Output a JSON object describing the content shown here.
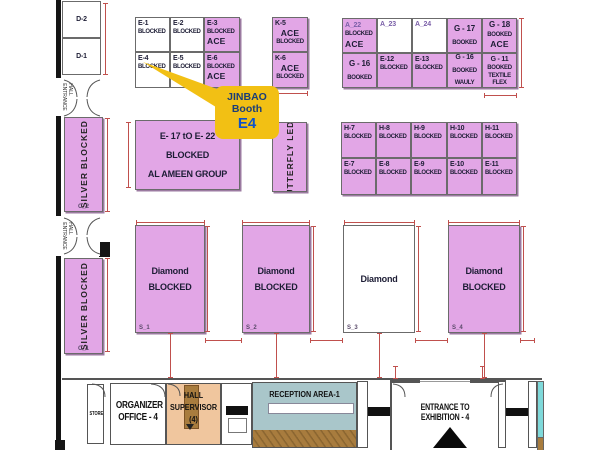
{
  "colors": {
    "pink": "#e2a6e6",
    "yellow": "#f2c014",
    "navy": "#1b3d77",
    "blue": "#0d52c8",
    "red": "#c0504d",
    "orange": "#f0c69e",
    "teal": "#a9c6ca",
    "tealstrip": "#7fd9da",
    "wood": "#a87c3e"
  },
  "callout": {
    "brand": "JINBAO",
    "line2": "Booth",
    "booth_id": "E4"
  },
  "left_wing": {
    "hall_entrance": "HALL ENTRANCE"
  },
  "bottom_band": {
    "store": "STORE",
    "organizer_line1": "ORGANIZER",
    "organizer_line2": "OFFICE - 4",
    "supervisor_lines": [
      "HALL",
      "SUPERVISOR",
      "(4)"
    ],
    "reception": "RECEPTION AREA-1",
    "entrance": "ENTRANCE TO EXHIBITION - 4"
  },
  "booths": [
    {
      "id": "D-2",
      "x": 62,
      "y": 1,
      "w": 39,
      "h": 37,
      "fill": "white",
      "cls": "mid",
      "lines": [
        {
          "t": "D-2",
          "c": "id c"
        }
      ]
    },
    {
      "id": "D-1",
      "x": 62,
      "y": 38,
      "w": 39,
      "h": 37,
      "fill": "white",
      "cls": "mid",
      "lines": [
        {
          "t": "D-1",
          "c": "id c"
        }
      ]
    },
    {
      "id": "C_2",
      "x": 64,
      "y": 117,
      "w": 39,
      "h": 95,
      "fill": "pink",
      "vert": true,
      "tag": "C_2",
      "lines": [
        {
          "t": "SILVER"
        },
        {
          "t": "BLOCKED"
        }
      ]
    },
    {
      "id": "C_1",
      "x": 64,
      "y": 258,
      "w": 39,
      "h": 96,
      "fill": "pink",
      "vert": true,
      "tag": "C_1",
      "lines": [
        {
          "t": "SILVER"
        },
        {
          "t": "BLOCKED"
        }
      ]
    },
    {
      "id": "E-1",
      "x": 135,
      "y": 17,
      "w": 35,
      "h": 35,
      "fill": "white",
      "lines": [
        {
          "t": "E-1",
          "c": "id"
        },
        {
          "t": "BLOCKED",
          "c": "t"
        }
      ]
    },
    {
      "id": "E-2",
      "x": 170,
      "y": 17,
      "w": 34,
      "h": 35,
      "fill": "white",
      "lines": [
        {
          "t": "E-2",
          "c": "id"
        },
        {
          "t": "BLOCKED",
          "c": "t"
        }
      ]
    },
    {
      "id": "E-3",
      "x": 204,
      "y": 17,
      "w": 36,
      "h": 35,
      "fill": "pink",
      "lines": [
        {
          "t": "E-3",
          "c": "id"
        },
        {
          "t": "BLOCKED",
          "c": "t"
        },
        {
          "t": "ACE",
          "c": "a"
        }
      ]
    },
    {
      "id": "E-4",
      "x": 135,
      "y": 52,
      "w": 35,
      "h": 36,
      "fill": "white",
      "lines": [
        {
          "t": "E-4",
          "c": "id"
        },
        {
          "t": "BLOCKED",
          "c": "t"
        }
      ]
    },
    {
      "id": "E-5",
      "x": 170,
      "y": 52,
      "w": 34,
      "h": 36,
      "fill": "white",
      "lines": [
        {
          "t": "E-5",
          "c": "id"
        },
        {
          "t": "BLOCKED",
          "c": "t"
        }
      ]
    },
    {
      "id": "E-6",
      "x": 204,
      "y": 52,
      "w": 36,
      "h": 36,
      "fill": "pink",
      "lines": [
        {
          "t": "E-6",
          "c": "id"
        },
        {
          "t": "BLOCKED",
          "c": "t"
        },
        {
          "t": "ACE",
          "c": "a"
        }
      ]
    },
    {
      "id": "K-5",
      "x": 272,
      "y": 17,
      "w": 36,
      "h": 35,
      "fill": "pink",
      "lines": [
        {
          "t": "K-5",
          "c": "id"
        },
        {
          "t": "ACE",
          "c": "a c"
        },
        {
          "t": "BLOCKED",
          "c": "t c"
        }
      ]
    },
    {
      "id": "K-6",
      "x": 272,
      "y": 52,
      "w": 36,
      "h": 36,
      "fill": "pink",
      "lines": [
        {
          "t": "K-6",
          "c": "id"
        },
        {
          "t": "ACE",
          "c": "a c"
        },
        {
          "t": "BLOCKED",
          "c": "t c"
        }
      ]
    },
    {
      "id": "A_22",
      "x": 342,
      "y": 18,
      "w": 35,
      "h": 35,
      "fill": "pink",
      "cls": "sp",
      "lines": [
        {
          "t": "A_22",
          "c": "id p"
        },
        {
          "t": "BLOCKED",
          "c": "t"
        },
        {
          "t": "ACE",
          "c": "a"
        }
      ]
    },
    {
      "id": "A_23",
      "x": 377,
      "y": 18,
      "w": 35,
      "h": 35,
      "fill": "white",
      "lines": [
        {
          "t": "A_23",
          "c": "id p"
        }
      ]
    },
    {
      "id": "A_24",
      "x": 412,
      "y": 18,
      "w": 35,
      "h": 35,
      "fill": "white",
      "lines": [
        {
          "t": "A_24",
          "c": "id p"
        }
      ]
    },
    {
      "id": "G-17",
      "x": 447,
      "y": 18,
      "w": 35,
      "h": 35,
      "fill": "pink",
      "cls": "mid",
      "lines": [
        {
          "t": "G - 17",
          "c": "b c"
        },
        {
          "t": "BOOKED",
          "c": "t c"
        }
      ]
    },
    {
      "id": "G-18",
      "x": 482,
      "y": 18,
      "w": 35,
      "h": 35,
      "fill": "pink",
      "cls": "sp",
      "lines": [
        {
          "t": "G - 18",
          "c": "b c"
        },
        {
          "t": "BOOKED",
          "c": "t c"
        },
        {
          "t": "ACE",
          "c": "a c"
        }
      ]
    },
    {
      "id": "G-16",
      "x": 342,
      "y": 53,
      "w": 35,
      "h": 35,
      "fill": "pink",
      "cls": "mid",
      "lines": [
        {
          "t": "G - 16",
          "c": "b c"
        },
        {
          "t": "BOOKED",
          "c": "t c"
        }
      ]
    },
    {
      "id": "E-12",
      "x": 377,
      "y": 53,
      "w": 35,
      "h": 35,
      "fill": "pink",
      "lines": [
        {
          "t": "E-12",
          "c": "id"
        },
        {
          "t": "BLOCKED",
          "c": "t"
        }
      ]
    },
    {
      "id": "E-13",
      "x": 412,
      "y": 53,
      "w": 35,
      "h": 35,
      "fill": "pink",
      "lines": [
        {
          "t": "E-13",
          "c": "id"
        },
        {
          "t": "BLOCKED",
          "c": "t"
        }
      ]
    },
    {
      "id": "G-16-WAULY",
      "x": 447,
      "y": 53,
      "w": 35,
      "h": 35,
      "fill": "pink",
      "cls": "mid",
      "lines": [
        {
          "t": "G - 16",
          "c": "id c"
        },
        {
          "t": "BOOKED",
          "c": "t c"
        },
        {
          "t": "WAULY",
          "c": "t c"
        }
      ]
    },
    {
      "id": "G-11",
      "x": 482,
      "y": 53,
      "w": 35,
      "h": 35,
      "fill": "pink",
      "lines": [
        {
          "t": "G - 11",
          "c": "id c"
        },
        {
          "t": "BOOKED",
          "c": "t c"
        },
        {
          "t": "TEXTILE",
          "c": "t c"
        },
        {
          "t": "FLEX",
          "c": "t c"
        }
      ]
    },
    {
      "id": "E-17-to-E-22",
      "x": 135,
      "y": 120,
      "w": 105,
      "h": 70,
      "fill": "pink",
      "cls": "sp",
      "lines": [
        {
          "t": "E- 17 tO E- 22",
          "c": "m c"
        },
        {
          "t": "BLOCKED",
          "c": "m c"
        },
        {
          "t": "AL AMEEN GROUP",
          "c": "m c"
        }
      ]
    },
    {
      "id": "G-7-12",
      "x": 272,
      "y": 122,
      "w": 35,
      "h": 70,
      "fill": "pink",
      "vert": true,
      "top": "G--7&12",
      "lines": [
        {
          "t": "BUTTERFLY"
        },
        {
          "t": "LED"
        }
      ]
    },
    {
      "id": "H-7",
      "x": 341,
      "y": 122,
      "w": 35,
      "h": 36,
      "fill": "pink",
      "lines": [
        {
          "t": "H-7",
          "c": "id"
        },
        {
          "t": "BLOCKED",
          "c": "t"
        }
      ]
    },
    {
      "id": "H-8",
      "x": 376,
      "y": 122,
      "w": 35,
      "h": 36,
      "fill": "pink",
      "lines": [
        {
          "t": "H-8",
          "c": "id"
        },
        {
          "t": "BLOCKED",
          "c": "t"
        }
      ]
    },
    {
      "id": "H-9",
      "x": 411,
      "y": 122,
      "w": 36,
      "h": 36,
      "fill": "pink",
      "lines": [
        {
          "t": "H-9",
          "c": "id"
        },
        {
          "t": "BLOCKED",
          "c": "t"
        }
      ]
    },
    {
      "id": "H-10",
      "x": 447,
      "y": 122,
      "w": 35,
      "h": 36,
      "fill": "pink",
      "lines": [
        {
          "t": "H-10",
          "c": "id"
        },
        {
          "t": "BLOCKED",
          "c": "t"
        }
      ]
    },
    {
      "id": "H-11",
      "x": 482,
      "y": 122,
      "w": 35,
      "h": 36,
      "fill": "pink",
      "lines": [
        {
          "t": "H-11",
          "c": "id"
        },
        {
          "t": "BLOCKED",
          "c": "t"
        }
      ]
    },
    {
      "id": "E-7",
      "x": 341,
      "y": 158,
      "w": 35,
      "h": 37,
      "fill": "pink",
      "lines": [
        {
          "t": "E-7",
          "c": "id"
        },
        {
          "t": "BLOCKED",
          "c": "t"
        }
      ]
    },
    {
      "id": "E-8",
      "x": 376,
      "y": 158,
      "w": 35,
      "h": 37,
      "fill": "pink",
      "lines": [
        {
          "t": "E-8",
          "c": "id"
        },
        {
          "t": "BLOCKED",
          "c": "t"
        }
      ]
    },
    {
      "id": "E-9",
      "x": 411,
      "y": 158,
      "w": 36,
      "h": 37,
      "fill": "pink",
      "lines": [
        {
          "t": "E-9",
          "c": "id"
        },
        {
          "t": "BLOCKED",
          "c": "t"
        }
      ]
    },
    {
      "id": "E-10",
      "x": 447,
      "y": 158,
      "w": 35,
      "h": 37,
      "fill": "pink",
      "lines": [
        {
          "t": "E-10",
          "c": "id"
        },
        {
          "t": "BLOCKED",
          "c": "t"
        }
      ]
    },
    {
      "id": "E-11",
      "x": 482,
      "y": 158,
      "w": 35,
      "h": 37,
      "fill": "pink",
      "lines": [
        {
          "t": "E-11",
          "c": "id"
        },
        {
          "t": "BLOCKED",
          "c": "t"
        }
      ]
    },
    {
      "id": "S_1",
      "x": 135,
      "y": 225,
      "w": 70,
      "h": 108,
      "fill": "pink",
      "cls": "mid",
      "tag": "S_1",
      "lines": [
        {
          "t": "Diamond",
          "c": "m c"
        },
        {
          "t": "BLOCKED",
          "c": "m c"
        }
      ]
    },
    {
      "id": "S_2",
      "x": 242,
      "y": 225,
      "w": 68,
      "h": 108,
      "fill": "pink",
      "cls": "mid",
      "tag": "S_2",
      "lines": [
        {
          "t": "Diamond",
          "c": "m c"
        },
        {
          "t": "BLOCKED",
          "c": "m c"
        }
      ]
    },
    {
      "id": "S_3",
      "x": 343,
      "y": 225,
      "w": 72,
      "h": 108,
      "fill": "white",
      "cls": "mid",
      "tag": "S_3",
      "lines": [
        {
          "t": "Diamond",
          "c": "m c"
        }
      ]
    },
    {
      "id": "S_4",
      "x": 448,
      "y": 225,
      "w": 72,
      "h": 108,
      "fill": "pink",
      "cls": "mid",
      "tag": "S_4",
      "lines": [
        {
          "t": "Diamond",
          "c": "m c"
        },
        {
          "t": "BLOCKED",
          "c": "m c"
        }
      ]
    }
  ]
}
